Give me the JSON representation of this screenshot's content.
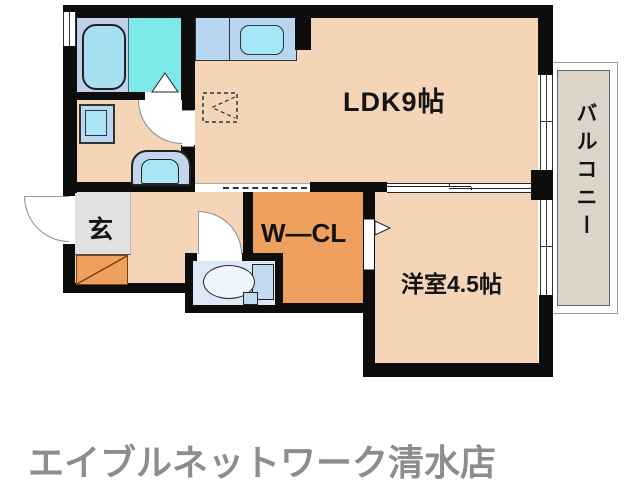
{
  "floorplan": {
    "rooms": {
      "ldk": "LDK9帖",
      "western": "洋室4.5帖",
      "closet": "W—CL",
      "entrance": "玄",
      "balcony": "バルコニー"
    },
    "colors": {
      "wall": "#0d0d0d",
      "floor_peach": "#f4d5b8",
      "closet_orange": "#ef9f5e",
      "entrance_gray": "#e1e1e1",
      "bathroom_cyan": "#7de9e9",
      "tub_area_blue": "#c1cfe8",
      "fixture_blue": "#a9e2f5",
      "counter_blue": "#b9d6f1",
      "toilet_floor": "#dce8f6",
      "balcony_fill": "#dcd3c9"
    },
    "fixtures": [
      "bathtub",
      "kitchen-sink",
      "washbasin",
      "vanity",
      "toilet",
      "refrigerator-space",
      "shoe-cabinet"
    ]
  },
  "footer": {
    "store_name": "エイブルネットワーク清水店"
  }
}
